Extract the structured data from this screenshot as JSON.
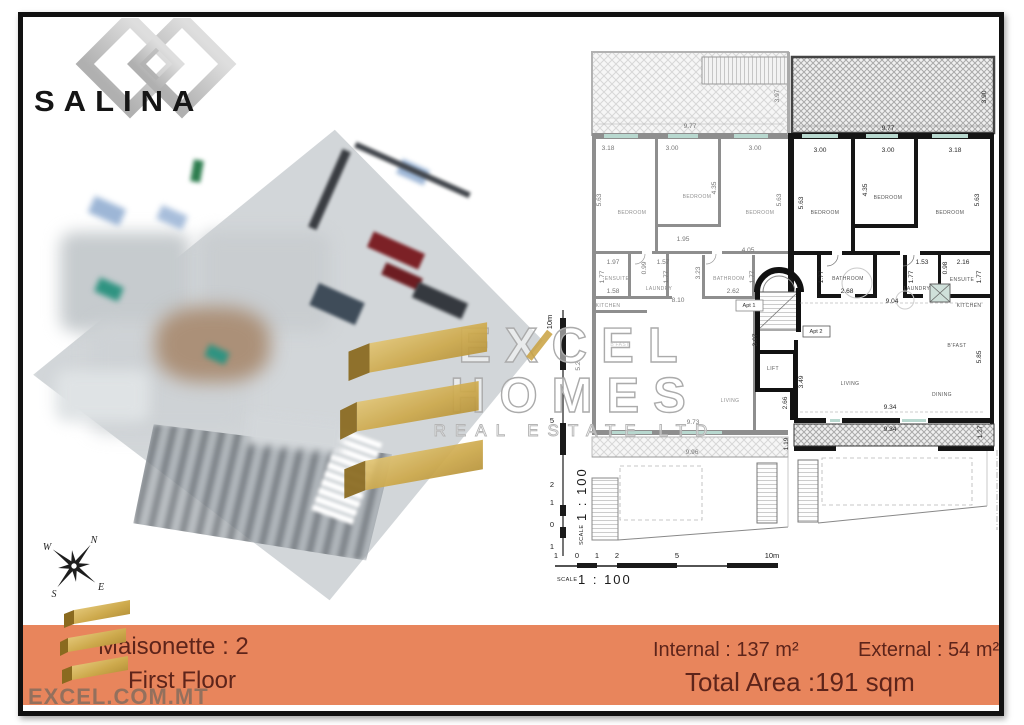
{
  "branding": {
    "salina": "SALINA",
    "watermark": {
      "line1": "EXCEL",
      "line2": "HOMES",
      "line3": "REAL ESTATE LTD"
    },
    "website": "EXCEL.COM.MT"
  },
  "banner": {
    "bg_color": "#E8855C",
    "text_color": "#5D241A",
    "maisonette": "Maisonette : 2",
    "floor": "First Floor",
    "internal": "Internal : 137 m²",
    "external": "External : 54 m²",
    "total": "Total Area :191 sqm"
  },
  "compass": {
    "n": "N",
    "e": "E",
    "s": "S",
    "w": "W"
  },
  "plan": {
    "scale_label": "SCALE",
    "scale_value": "1 : 100",
    "apt_tags": [
      {
        "t": "Apt 1",
        "x": 749,
        "y": 307
      },
      {
        "t": "Apt 2",
        "x": 816,
        "y": 333
      }
    ],
    "dims": [
      {
        "t": "9.77",
        "x": 690,
        "y": 128,
        "c": "g"
      },
      {
        "t": "3.97",
        "x": 779,
        "y": 96,
        "r": -90,
        "c": "g"
      },
      {
        "t": "9.77",
        "x": 888,
        "y": 130,
        "c": "k"
      },
      {
        "t": "3.90",
        "x": 986,
        "y": 97,
        "r": -90,
        "c": "k"
      },
      {
        "t": "3.18",
        "x": 608,
        "y": 150,
        "c": "g"
      },
      {
        "t": "3.00",
        "x": 672,
        "y": 150,
        "c": "g"
      },
      {
        "t": "3.00",
        "x": 755,
        "y": 150,
        "c": "g"
      },
      {
        "t": "3.00",
        "x": 820,
        "y": 152,
        "c": "k"
      },
      {
        "t": "3.00",
        "x": 888,
        "y": 152,
        "c": "k"
      },
      {
        "t": "3.18",
        "x": 955,
        "y": 152,
        "c": "k"
      },
      {
        "t": "5.63",
        "x": 601,
        "y": 200,
        "r": -90,
        "c": "g"
      },
      {
        "t": "4.35",
        "x": 716,
        "y": 188,
        "r": -90,
        "c": "g"
      },
      {
        "t": "5.63",
        "x": 781,
        "y": 200,
        "r": -90,
        "c": "g"
      },
      {
        "t": "5.63",
        "x": 803,
        "y": 203,
        "r": -90,
        "c": "k"
      },
      {
        "t": "4.35",
        "x": 867,
        "y": 190,
        "r": -90,
        "c": "k"
      },
      {
        "t": "5.63",
        "x": 979,
        "y": 200,
        "r": -90,
        "c": "k"
      },
      {
        "t": "1.95",
        "x": 683,
        "y": 241,
        "c": "g"
      },
      {
        "t": "4.05",
        "x": 748,
        "y": 252,
        "c": "g"
      },
      {
        "t": "1.97",
        "x": 613,
        "y": 264,
        "c": "g"
      },
      {
        "t": "0.99",
        "x": 646,
        "y": 268,
        "r": -90,
        "c": "g"
      },
      {
        "t": "1.57",
        "x": 663,
        "y": 264,
        "c": "g"
      },
      {
        "t": "1.77",
        "x": 604,
        "y": 277,
        "r": -90,
        "c": "g"
      },
      {
        "t": "1.77",
        "x": 668,
        "y": 277,
        "r": -90,
        "c": "g"
      },
      {
        "t": "1.58",
        "x": 613,
        "y": 293,
        "c": "g"
      },
      {
        "t": "3.23",
        "x": 700,
        "y": 273,
        "r": -90,
        "c": "g"
      },
      {
        "t": "1.77",
        "x": 754,
        "y": 277,
        "r": -90,
        "c": "g"
      },
      {
        "t": "2.62",
        "x": 733,
        "y": 293,
        "c": "g"
      },
      {
        "t": "8.10",
        "x": 678,
        "y": 302,
        "c": "g"
      },
      {
        "t": "1.77",
        "x": 823,
        "y": 277,
        "r": -90,
        "c": "k"
      },
      {
        "t": "2.68",
        "x": 847,
        "y": 293,
        "c": "k"
      },
      {
        "t": "1.53",
        "x": 922,
        "y": 264,
        "c": "k"
      },
      {
        "t": "0.98",
        "x": 947,
        "y": 268,
        "r": -90,
        "c": "k"
      },
      {
        "t": "2.16",
        "x": 963,
        "y": 264,
        "c": "k"
      },
      {
        "t": "1.77",
        "x": 913,
        "y": 277,
        "r": -90,
        "c": "k"
      },
      {
        "t": "1.77",
        "x": 981,
        "y": 277,
        "r": -90,
        "c": "k"
      },
      {
        "t": "9.04",
        "x": 892,
        "y": 303,
        "c": "k"
      },
      {
        "t": "3.07",
        "x": 757,
        "y": 340,
        "r": -90,
        "c": "k"
      },
      {
        "t": "3.49",
        "x": 803,
        "y": 382,
        "r": -90,
        "c": "k"
      },
      {
        "t": "2.66",
        "x": 787,
        "y": 403,
        "r": -90,
        "c": "k"
      },
      {
        "t": "5.2",
        "x": 580,
        "y": 366,
        "r": -90,
        "c": "g"
      },
      {
        "t": "5.85",
        "x": 981,
        "y": 357,
        "r": -90,
        "c": "k"
      },
      {
        "t": "9.34",
        "x": 890,
        "y": 409,
        "c": "k"
      },
      {
        "t": "9.34",
        "x": 890,
        "y": 431,
        "c": "k"
      },
      {
        "t": "1.27",
        "x": 982,
        "y": 432,
        "r": -90,
        "c": "k"
      },
      {
        "t": "9.73",
        "x": 693,
        "y": 424,
        "c": "g"
      },
      {
        "t": "9.96",
        "x": 692,
        "y": 454,
        "c": "g"
      },
      {
        "t": "1.19",
        "x": 788,
        "y": 444,
        "r": -90,
        "c": "k"
      }
    ],
    "rooms": [
      {
        "t": "BEDROOM",
        "x": 632,
        "y": 214,
        "c": "g"
      },
      {
        "t": "BEDROOM",
        "x": 697,
        "y": 198,
        "c": "g"
      },
      {
        "t": "BEDROOM",
        "x": 760,
        "y": 214,
        "c": "g"
      },
      {
        "t": "ENSUITE",
        "x": 617,
        "y": 280,
        "c": "g"
      },
      {
        "t": "LAUNDRY",
        "x": 659,
        "y": 290,
        "c": "g"
      },
      {
        "t": "BATHROOM",
        "x": 729,
        "y": 280,
        "c": "g"
      },
      {
        "t": "KITCHEN",
        "x": 608,
        "y": 307,
        "c": "g"
      },
      {
        "t": "B'FAST",
        "x": 620,
        "y": 346,
        "c": "g"
      },
      {
        "t": "LIVING",
        "x": 730,
        "y": 402,
        "c": "g"
      },
      {
        "t": "BEDROOM",
        "x": 825,
        "y": 214,
        "c": "k"
      },
      {
        "t": "BEDROOM",
        "x": 888,
        "y": 199,
        "c": "k"
      },
      {
        "t": "BEDROOM",
        "x": 950,
        "y": 214,
        "c": "k"
      },
      {
        "t": "BATHROOM",
        "x": 848,
        "y": 280,
        "c": "k"
      },
      {
        "t": "LAUNDRY",
        "x": 917,
        "y": 290,
        "c": "k"
      },
      {
        "t": "ENSUITE",
        "x": 962,
        "y": 281,
        "c": "k"
      },
      {
        "t": "KITCHEN",
        "x": 969,
        "y": 307,
        "c": "k"
      },
      {
        "t": "B'FAST",
        "x": 957,
        "y": 347,
        "c": "k"
      },
      {
        "t": "LIVING",
        "x": 850,
        "y": 385,
        "c": "k"
      },
      {
        "t": "DINING",
        "x": 942,
        "y": 396,
        "c": "k"
      },
      {
        "t": "LIFT",
        "x": 773,
        "y": 370,
        "c": "k"
      }
    ],
    "v_ruler": {
      "x": 552,
      "ticks": [
        {
          "t": "10m",
          "y": 322,
          "r": -90
        },
        {
          "t": "5",
          "y": 423
        },
        {
          "t": "2",
          "y": 487
        },
        {
          "t": "1",
          "y": 505
        },
        {
          "t": "0",
          "y": 527
        },
        {
          "t": "1",
          "y": 549
        }
      ]
    },
    "h_ruler": {
      "y": 558,
      "ticks": [
        {
          "t": "1",
          "x": 556
        },
        {
          "t": "0",
          "x": 577
        },
        {
          "t": "1",
          "x": 597
        },
        {
          "t": "2",
          "x": 617
        },
        {
          "t": "5",
          "x": 677
        },
        {
          "t": "10m",
          "x": 772
        }
      ]
    }
  }
}
